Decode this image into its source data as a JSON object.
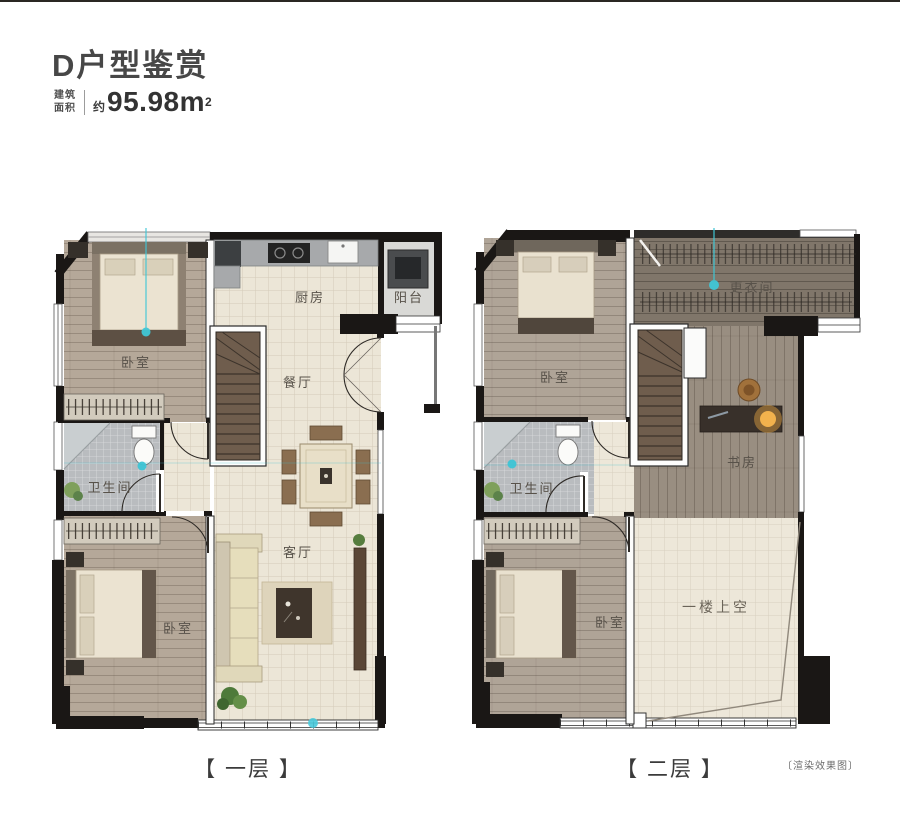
{
  "header": {
    "title": "D户型鉴赏",
    "area_label_top": "建筑",
    "area_label_bottom": "面积",
    "area_approx": "约",
    "area_value": "95.98m",
    "area_unit_sup": "2"
  },
  "floor1": {
    "caption": "【 一层 】",
    "rooms": {
      "bedroom_top": "卧室",
      "kitchen": "厨房",
      "balcony": "阳台",
      "dining": "餐厅",
      "bathroom": "卫生间",
      "living": "客厅",
      "bedroom_bottom": "卧室"
    }
  },
  "floor2": {
    "caption": "【 二层 】",
    "rooms": {
      "bedroom_top": "卧室",
      "cloakroom": "更衣间",
      "study": "书房",
      "bathroom": "卫生间",
      "bedroom_bottom": "卧室",
      "void": "一楼上空"
    }
  },
  "footnote": "〔渲染效果图〕",
  "colors": {
    "wall": "#1a1715",
    "wood_floor": "#b5a899",
    "tile_floor": "#ece6d7",
    "bath_tile": "#b9bcbf",
    "cloak_floor": "#80766a",
    "stair_wood": "#6f5d4d",
    "accent_teal": "#3fc6d6"
  }
}
